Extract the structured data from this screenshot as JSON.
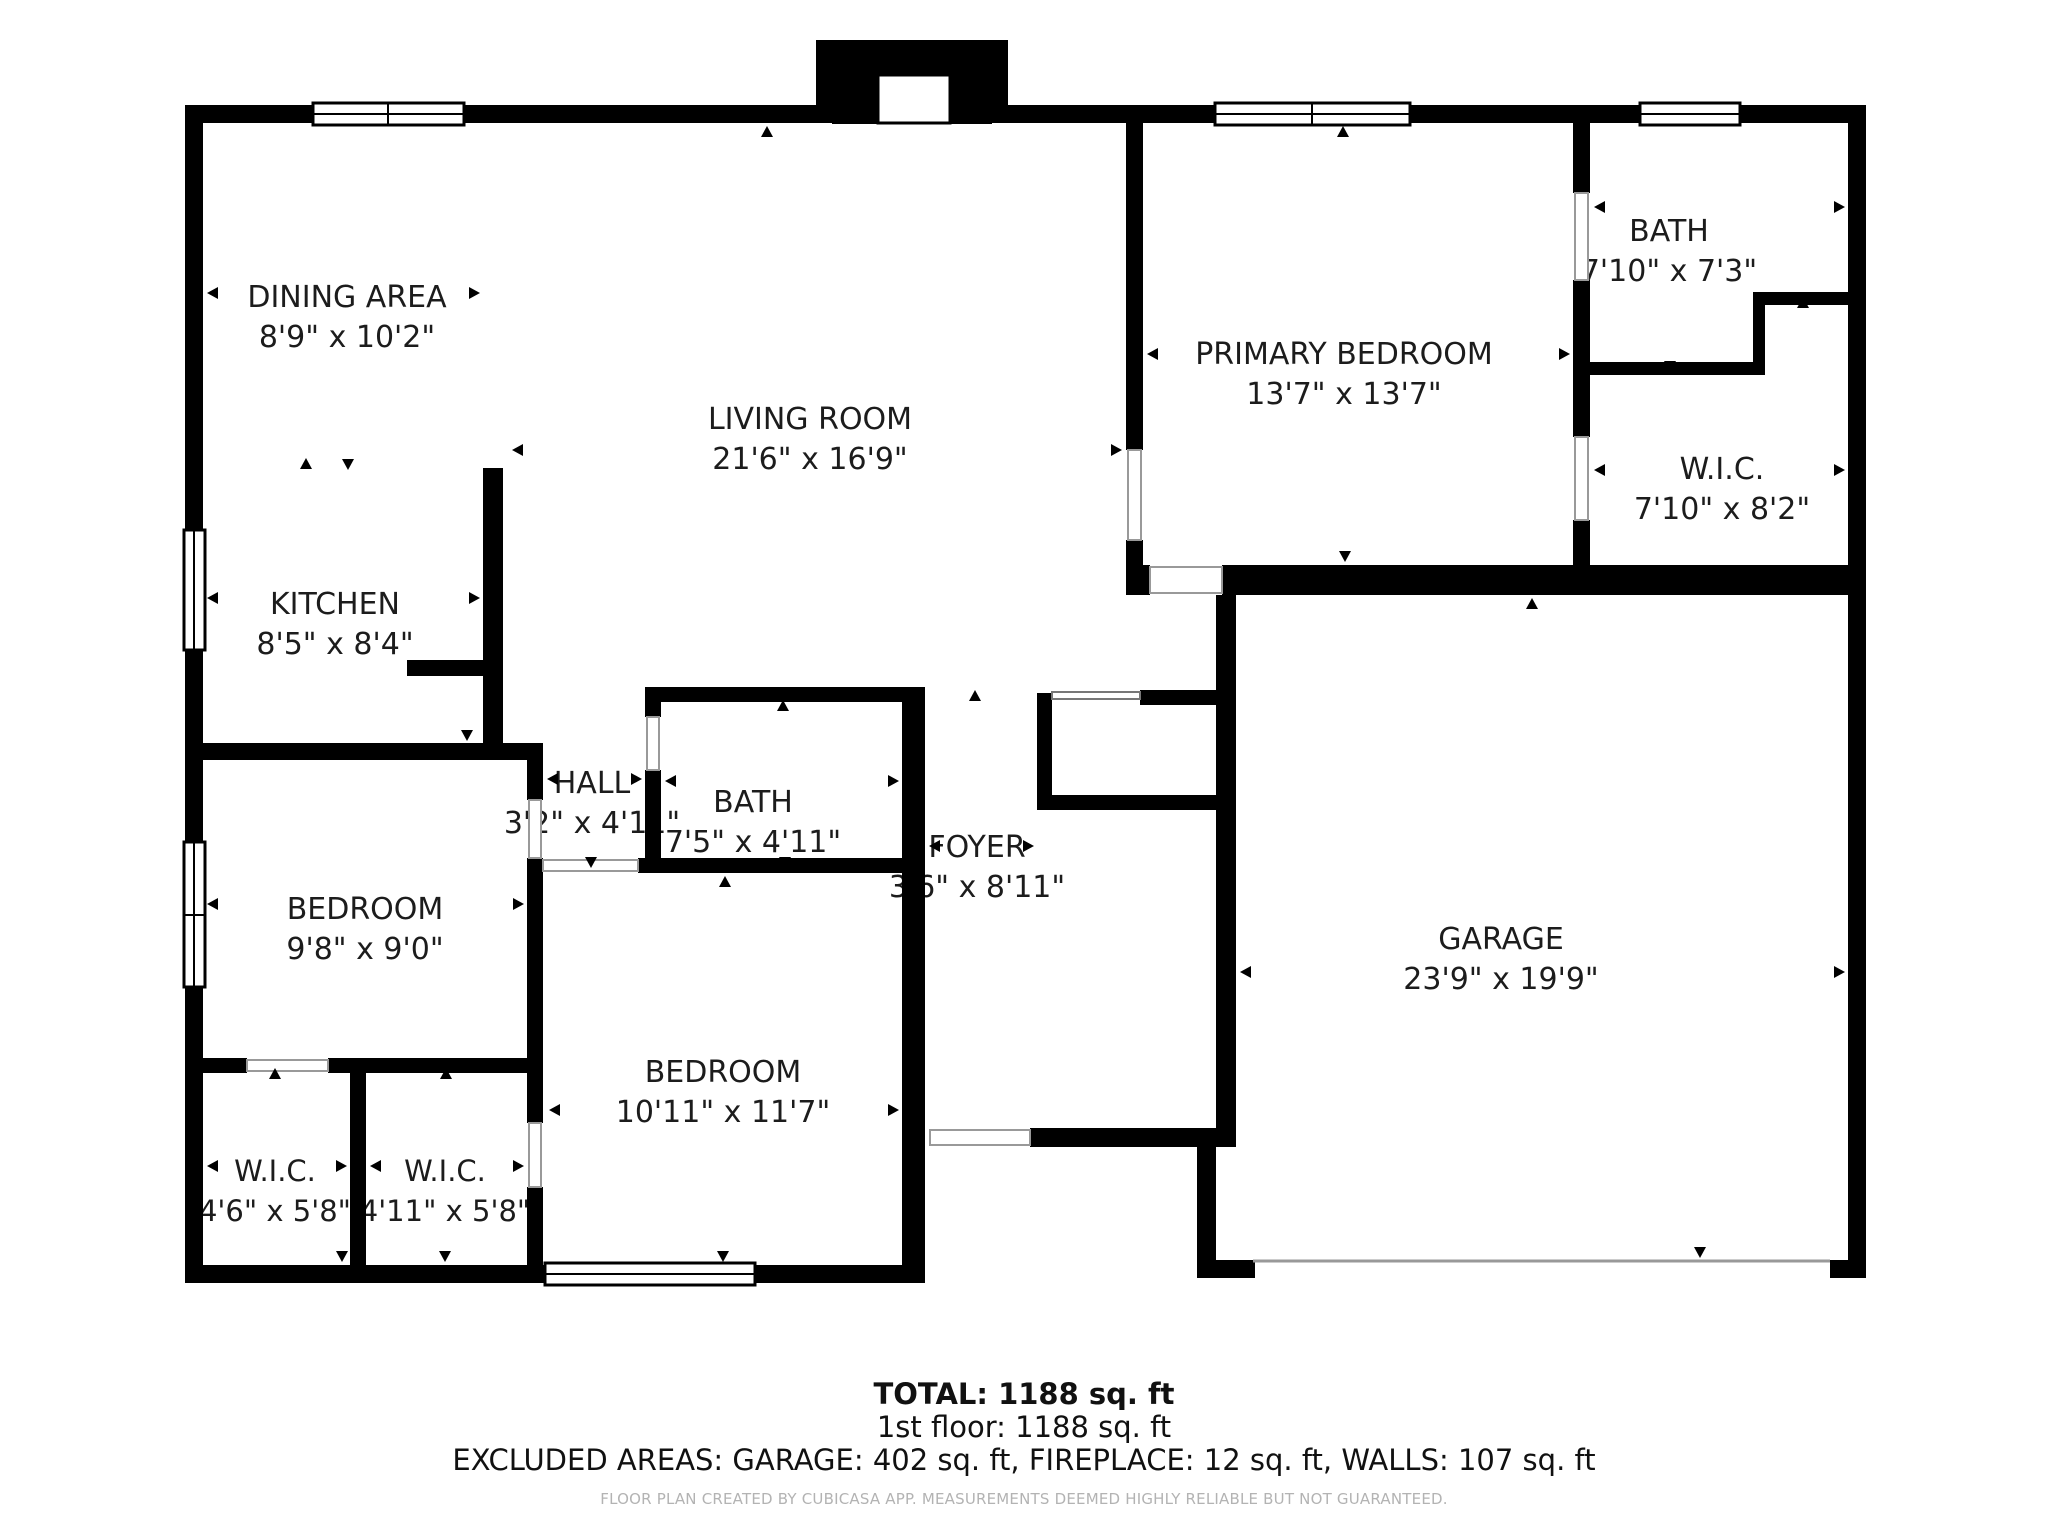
{
  "rooms": {
    "dining": {
      "name": "DINING AREA",
      "dims": "8'9\" x 10'2\""
    },
    "living": {
      "name": "LIVING ROOM",
      "dims": "21'6\" x 16'9\""
    },
    "kitchen": {
      "name": "KITCHEN",
      "dims": "8'5\" x 8'4\""
    },
    "primary_bedroom": {
      "name": "PRIMARY BEDROOM",
      "dims": "13'7\" x 13'7\""
    },
    "bath_top": {
      "name": "BATH",
      "dims": "7'10\" x 7'3\""
    },
    "wic_right": {
      "name": "W.I.C.",
      "dims": "7'10\" x 8'2\""
    },
    "hall": {
      "name": "HALL",
      "dims": "3'2\" x 4'11\""
    },
    "bath_mid": {
      "name": "BATH",
      "dims": "7'5\" x 4'11\""
    },
    "foyer": {
      "name": "FOYER",
      "dims": "3'6\" x 8'11\""
    },
    "bedroom_left": {
      "name": "BEDROOM",
      "dims": "9'8\" x 9'0\""
    },
    "bedroom_bottom": {
      "name": "BEDROOM",
      "dims": "10'11\" x 11'7\""
    },
    "wic_bottom_left": {
      "name": "W.I.C.",
      "dims": "4'6\" x 5'8\""
    },
    "wic_bottom_mid": {
      "name": "W.I.C.",
      "dims": "4'11\" x 5'8\""
    },
    "garage": {
      "name": "GARAGE",
      "dims": "23'9\" x 19'9\""
    }
  },
  "summary": {
    "total": "TOTAL: 1188 sq. ft",
    "first_floor": "1st floor: 1188 sq. ft",
    "excluded": "EXCLUDED AREAS: GARAGE: 402 sq. ft, FIREPLACE: 12 sq. ft, WALLS: 107 sq. ft",
    "disclaimer": "FLOOR PLAN CREATED BY CUBICASA APP. MEASUREMENTS DEEMED HIGHLY RELIABLE BUT NOT GUARANTEED."
  },
  "colors": {
    "wall": "#000000",
    "background": "#ffffff",
    "door_symbol": "#999999",
    "disclaimer_text": "#b3b3b3"
  }
}
